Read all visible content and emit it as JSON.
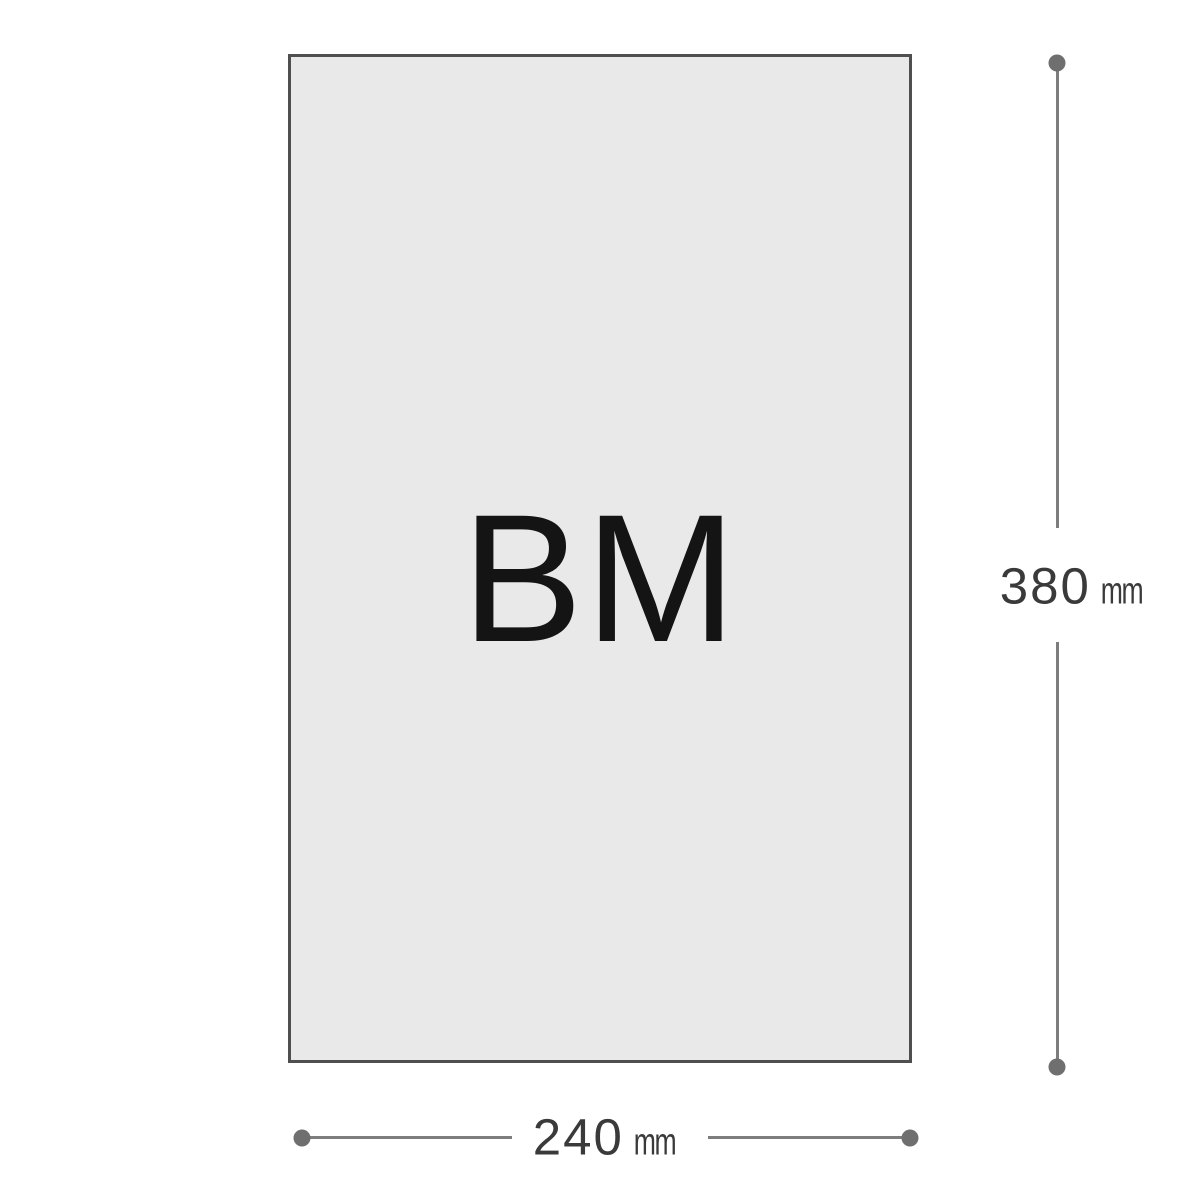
{
  "diagram": {
    "panel_label": "BM",
    "height_dimension": {
      "value": "380",
      "unit": "mm"
    },
    "width_dimension": {
      "value": "240",
      "unit": "mm"
    }
  },
  "colors": {
    "rect_fill": "#e9e9e9",
    "rect_border": "#4f4f4f",
    "dimension_line": "#7d7d7d",
    "dimension_dot": "#6f6f6f",
    "dimension_text": "#3a3a3a",
    "label_text": "#141414"
  }
}
